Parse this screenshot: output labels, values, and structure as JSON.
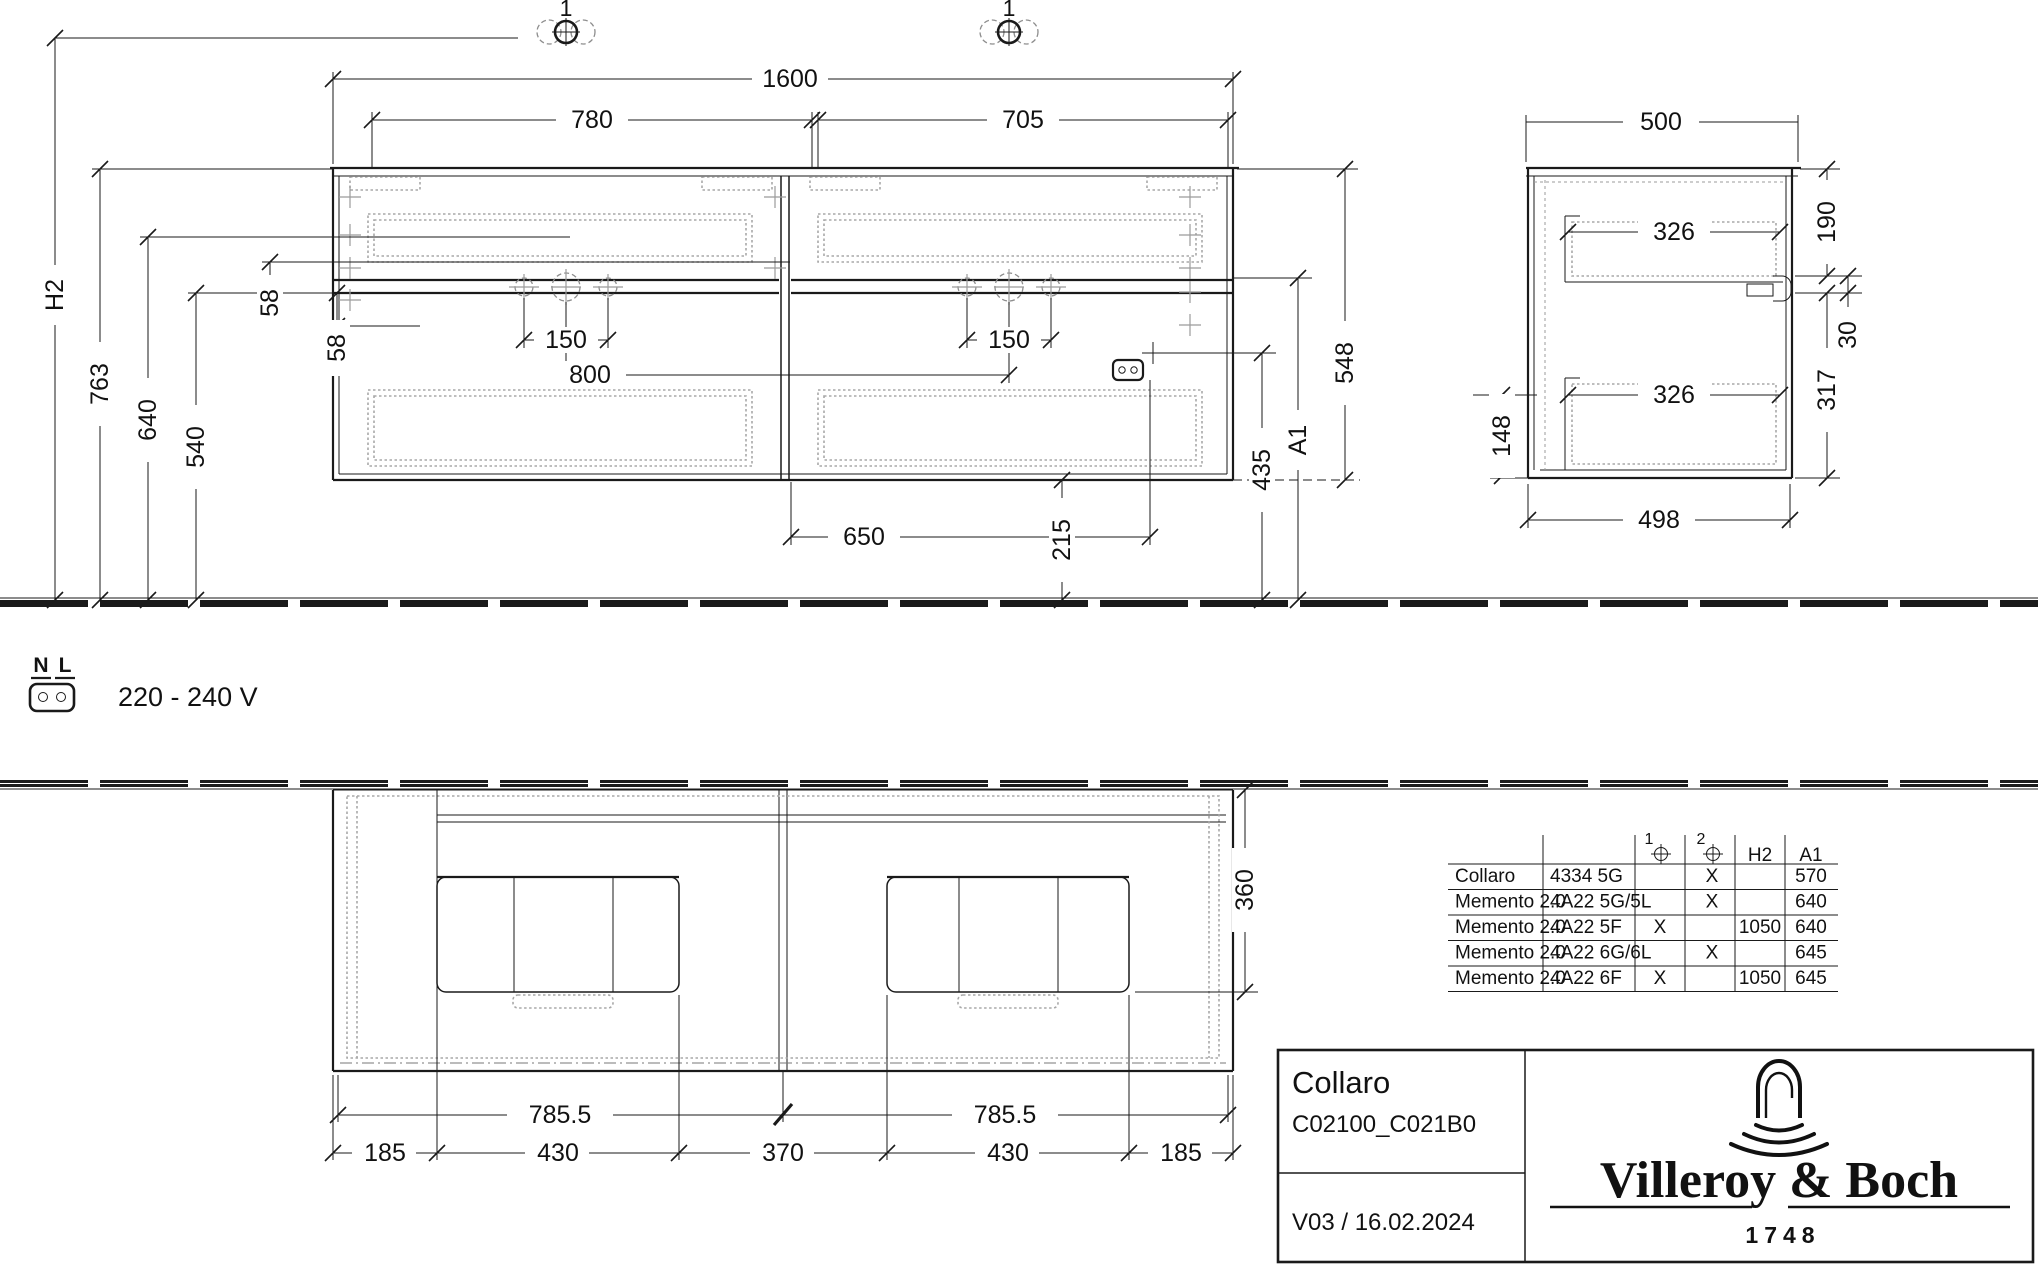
{
  "front_view": {
    "marker_left": "1",
    "marker_right": "1",
    "dims": {
      "overall_width": "1600",
      "left_width": "780",
      "right_width": "705",
      "hole_spacing_left": "150",
      "hole_spacing_right": "150",
      "hole_distance": "800",
      "socket_distance": "650",
      "cabinet_height": "548",
      "height_a1": "A1",
      "socket_height": "435",
      "floor_clearance": "215",
      "wall_height": "H2",
      "top_height": "763",
      "basin_height": "640",
      "apron_height": "540",
      "gap_upper": "58",
      "gap_lower": "58"
    }
  },
  "side_view": {
    "dims": {
      "depth": "500",
      "top_zone": "190",
      "shelf_upper": "326",
      "gap": "30",
      "lower_zone": "317",
      "shelf_lower": "326",
      "bottom_gap": "148",
      "body_depth": "498"
    }
  },
  "plan_view": {
    "dims": {
      "counter_depth": "360",
      "module_left": "785.5",
      "module_right": "785.5",
      "seg1": "185",
      "seg2": "430",
      "seg3": "370",
      "seg4": "430",
      "seg5": "185"
    }
  },
  "electrical": {
    "terminal_n": "N",
    "terminal_l": "L",
    "voltage": "220 - 240 V"
  },
  "table": {
    "headers": {
      "m1": "1",
      "m2": "2",
      "h2": "H2",
      "a1": "A1"
    },
    "rows": [
      {
        "series": "Collaro",
        "code": "4334 5G",
        "m1": "",
        "m2": "X",
        "h2": "",
        "a1": "570"
      },
      {
        "series": "Memento 2.0",
        "code": "4A22 5G/5L",
        "m1": "",
        "m2": "X",
        "h2": "",
        "a1": "640"
      },
      {
        "series": "Memento 2.0",
        "code": "4A22 5F",
        "m1": "X",
        "m2": "",
        "h2": "1050",
        "a1": "640"
      },
      {
        "series": "Memento 2.0",
        "code": "4A22 6G/6L",
        "m1": "",
        "m2": "X",
        "h2": "",
        "a1": "645"
      },
      {
        "series": "Memento 2.0",
        "code": "4A22 6F",
        "m1": "X",
        "m2": "",
        "h2": "1050",
        "a1": "645"
      }
    ]
  },
  "title_block": {
    "product": "Collaro",
    "article": "C02100_C021B0",
    "version": "V03 / 16.02.2024",
    "brand": "Villeroy & Boch",
    "since": "1748"
  }
}
